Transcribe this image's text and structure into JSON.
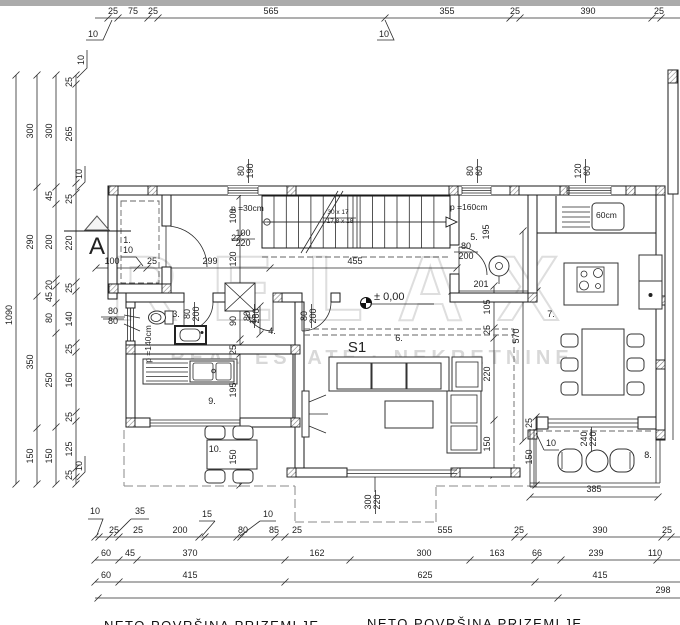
{
  "labels": {
    "watermark": [
      {
        "t": "RELAX",
        "x": 352,
        "y": 320,
        "c": "wm1"
      },
      {
        "t": "REAL ESTATE · NEKRETNINE",
        "x": 372,
        "y": 364,
        "c": "wm2"
      }
    ],
    "titles": [
      {
        "t": "NETO POVRŠINA   PRIZEMLJE",
        "x": 104,
        "y": 630,
        "an": "start",
        "c": "title"
      },
      {
        "t": "NETO POVRŠINA   PRIZEMLJE",
        "x": 367,
        "y": 628,
        "an": "start",
        "c": "title"
      }
    ],
    "dims_top": [
      {
        "t": "25",
        "x": 113,
        "y": 14
      },
      {
        "t": "75",
        "x": 133,
        "y": 14
      },
      {
        "t": "25",
        "x": 153,
        "y": 14
      },
      {
        "t": "565",
        "x": 271,
        "y": 14
      },
      {
        "t": "355",
        "x": 447,
        "y": 14
      },
      {
        "t": "25",
        "x": 515,
        "y": 14
      },
      {
        "t": "390",
        "x": 588,
        "y": 14
      },
      {
        "t": "25",
        "x": 659,
        "y": 14
      }
    ],
    "dims_left": [
      {
        "t": "1090",
        "x": 12,
        "y": 315,
        "r": 1
      },
      {
        "t": "300",
        "x": 33,
        "y": 131,
        "r": 1
      },
      {
        "t": "290",
        "x": 33,
        "y": 242,
        "r": 1
      },
      {
        "t": "350",
        "x": 33,
        "y": 362,
        "r": 1
      },
      {
        "t": "150",
        "x": 33,
        "y": 456,
        "r": 1
      },
      {
        "t": "300",
        "x": 52,
        "y": 131,
        "r": 1
      },
      {
        "t": "45",
        "x": 52,
        "y": 196,
        "r": 1
      },
      {
        "t": "200",
        "x": 52,
        "y": 242,
        "r": 1
      },
      {
        "t": "20",
        "x": 52,
        "y": 285,
        "r": 1
      },
      {
        "t": "45",
        "x": 52,
        "y": 297,
        "r": 1
      },
      {
        "t": "80",
        "x": 52,
        "y": 318,
        "r": 1
      },
      {
        "t": "250",
        "x": 52,
        "y": 380,
        "r": 1
      },
      {
        "t": "150",
        "x": 52,
        "y": 456,
        "r": 1
      },
      {
        "t": "25",
        "x": 72,
        "y": 82,
        "r": 1
      },
      {
        "t": "265",
        "x": 72,
        "y": 134,
        "r": 1
      },
      {
        "t": "25",
        "x": 72,
        "y": 199,
        "r": 1
      },
      {
        "t": "220",
        "x": 72,
        "y": 243,
        "r": 1
      },
      {
        "t": "25",
        "x": 72,
        "y": 288,
        "r": 1
      },
      {
        "t": "140",
        "x": 72,
        "y": 319,
        "r": 1
      },
      {
        "t": "25",
        "x": 72,
        "y": 349,
        "r": 1
      },
      {
        "t": "160",
        "x": 72,
        "y": 380,
        "r": 1
      },
      {
        "t": "25",
        "x": 72,
        "y": 417,
        "r": 1
      },
      {
        "t": "125",
        "x": 72,
        "y": 449,
        "r": 1
      },
      {
        "t": "25",
        "x": 72,
        "y": 475,
        "r": 1
      }
    ],
    "dims_bottom": [
      {
        "t": "25",
        "x": 114,
        "y": 533
      },
      {
        "t": "25",
        "x": 138,
        "y": 533
      },
      {
        "t": "200",
        "x": 180,
        "y": 533
      },
      {
        "t": "80",
        "x": 243,
        "y": 533
      },
      {
        "t": "85",
        "x": 274,
        "y": 533
      },
      {
        "t": "25",
        "x": 297,
        "y": 533
      },
      {
        "t": "555",
        "x": 445,
        "y": 533
      },
      {
        "t": "25",
        "x": 519,
        "y": 533
      },
      {
        "t": "390",
        "x": 600,
        "y": 533
      },
      {
        "t": "25",
        "x": 667,
        "y": 533
      },
      {
        "t": "60",
        "x": 106,
        "y": 556
      },
      {
        "t": "45",
        "x": 130,
        "y": 556
      },
      {
        "t": "370",
        "x": 190,
        "y": 556
      },
      {
        "t": "162",
        "x": 317,
        "y": 556
      },
      {
        "t": "300",
        "x": 424,
        "y": 556
      },
      {
        "t": "163",
        "x": 497,
        "y": 556
      },
      {
        "t": "66",
        "x": 537,
        "y": 556
      },
      {
        "t": "239",
        "x": 596,
        "y": 556
      },
      {
        "t": "110",
        "x": 655,
        "y": 556
      },
      {
        "t": "60",
        "x": 106,
        "y": 578
      },
      {
        "t": "415",
        "x": 190,
        "y": 578
      },
      {
        "t": "625",
        "x": 425,
        "y": 578
      },
      {
        "t": "415",
        "x": 600,
        "y": 578
      },
      {
        "t": "298",
        "x": 663,
        "y": 593
      }
    ],
    "dims_inner": [
      {
        "t": "100",
        "x": 112,
        "y": 264
      },
      {
        "t": "25",
        "x": 152,
        "y": 264
      },
      {
        "t": "299",
        "x": 210,
        "y": 264
      },
      {
        "t": "455",
        "x": 355,
        "y": 264
      },
      {
        "t": "201",
        "x": 481,
        "y": 287
      },
      {
        "t": "385",
        "x": 594,
        "y": 492
      },
      {
        "t": "100",
        "x": 236,
        "y": 216,
        "r": 1
      },
      {
        "t": "120",
        "x": 236,
        "y": 259,
        "r": 1
      },
      {
        "t": "90",
        "x": 236,
        "y": 321,
        "r": 1
      },
      {
        "t": "25",
        "x": 236,
        "y": 350,
        "r": 1
      },
      {
        "t": "195",
        "x": 236,
        "y": 390,
        "r": 1
      },
      {
        "t": "150",
        "x": 236,
        "y": 457,
        "r": 1
      },
      {
        "t": "15",
        "x": 256,
        "y": 319,
        "r": 1
      },
      {
        "t": "195",
        "x": 489,
        "y": 232,
        "r": 1
      },
      {
        "t": "105",
        "x": 490,
        "y": 307,
        "r": 1
      },
      {
        "t": "25",
        "x": 490,
        "y": 330,
        "r": 1
      },
      {
        "t": "220",
        "x": 490,
        "y": 374,
        "r": 1
      },
      {
        "t": "150",
        "x": 490,
        "y": 444,
        "r": 1
      },
      {
        "t": "570",
        "x": 519,
        "y": 336,
        "r": 1
      },
      {
        "t": "25",
        "x": 532,
        "y": 423,
        "r": 1
      },
      {
        "t": "150",
        "x": 532,
        "y": 457,
        "r": 1
      }
    ],
    "leaders": [
      {
        "t": "10",
        "x": 93,
        "y": 37
      },
      {
        "t": "10",
        "x": 384,
        "y": 37
      },
      {
        "t": "10",
        "x": 84,
        "y": 60,
        "r": 1
      },
      {
        "t": "10",
        "x": 82,
        "y": 174,
        "r": 1
      },
      {
        "t": "10",
        "x": 82,
        "y": 466,
        "r": 1
      },
      {
        "t": "10",
        "x": 95,
        "y": 514
      },
      {
        "t": "35",
        "x": 140,
        "y": 514
      },
      {
        "t": "15",
        "x": 207,
        "y": 517
      },
      {
        "t": "10",
        "x": 268,
        "y": 517
      },
      {
        "t": "10",
        "x": 128,
        "y": 253
      },
      {
        "t": "10",
        "x": 551,
        "y": 446
      }
    ],
    "fractions_h": [
      {
        "a": "100",
        "b": "220",
        "x": 243,
        "y": 236
      },
      {
        "a": "80",
        "b": "200",
        "x": 466,
        "y": 249
      },
      {
        "a": "80",
        "b": "80",
        "x": 113,
        "y": 314
      }
    ],
    "fractions_v": [
      {
        "a": "80",
        "b": "190",
        "x": 244,
        "y": 171,
        "r": 1
      },
      {
        "a": "80",
        "b": "60",
        "x": 473,
        "y": 171,
        "r": 1
      },
      {
        "a": "120",
        "b": "60",
        "x": 581,
        "y": 171,
        "r": 1
      },
      {
        "a": "80",
        "b": "200",
        "x": 190,
        "y": 314,
        "r": 1
      },
      {
        "a": "80",
        "b": "200",
        "x": 250,
        "y": 316,
        "r": 1
      },
      {
        "a": "80",
        "b": "200",
        "x": 307,
        "y": 316,
        "r": 1
      },
      {
        "a": "300",
        "b": "220",
        "x": 371,
        "y": 502,
        "r": 1
      },
      {
        "a": "240",
        "b": "220",
        "x": 587,
        "y": 439,
        "r": 1
      }
    ],
    "annotations": [
      {
        "t": "p =30cm",
        "x": 231,
        "y": 211,
        "an": "start",
        "s": 8.5
      },
      {
        "t": "p =160cm",
        "x": 450,
        "y": 210,
        "an": "start",
        "s": 8.5
      },
      {
        "t": "60cm",
        "x": 596,
        "y": 218,
        "an": "start",
        "s": 8.5
      },
      {
        "t": "p =140cm",
        "x": 151,
        "y": 344,
        "r": 1,
        "s": 8.5
      },
      {
        "t": "30 x 17",
        "x": 338,
        "y": 214,
        "s": 6.5
      },
      {
        "t": "17,8 x 18",
        "x": 340,
        "y": 223,
        "s": 6.5
      }
    ],
    "elevation": [
      {
        "t": "± 0,00",
        "x": 374,
        "y": 300,
        "an": "start",
        "s": 11
      }
    ],
    "section": [
      {
        "t": "A",
        "x": 97,
        "y": 254,
        "s": 24
      }
    ],
    "zone": [
      {
        "t": "S1",
        "x": 357,
        "y": 352,
        "s": 15
      }
    ],
    "room_labels": [
      {
        "t": "1.",
        "x": 127,
        "y": 243
      },
      {
        "t": "2.",
        "x": 235,
        "y": 241
      },
      {
        "t": "3.",
        "x": 176,
        "y": 317
      },
      {
        "t": "4.",
        "x": 272,
        "y": 334
      },
      {
        "t": "5.",
        "x": 474,
        "y": 240
      },
      {
        "t": "6.",
        "x": 399,
        "y": 341
      },
      {
        "t": "7.",
        "x": 551,
        "y": 317
      },
      {
        "t": "8.",
        "x": 648,
        "y": 458
      },
      {
        "t": "9.",
        "x": 212,
        "y": 404
      },
      {
        "t": "10.",
        "x": 215,
        "y": 452
      }
    ]
  }
}
